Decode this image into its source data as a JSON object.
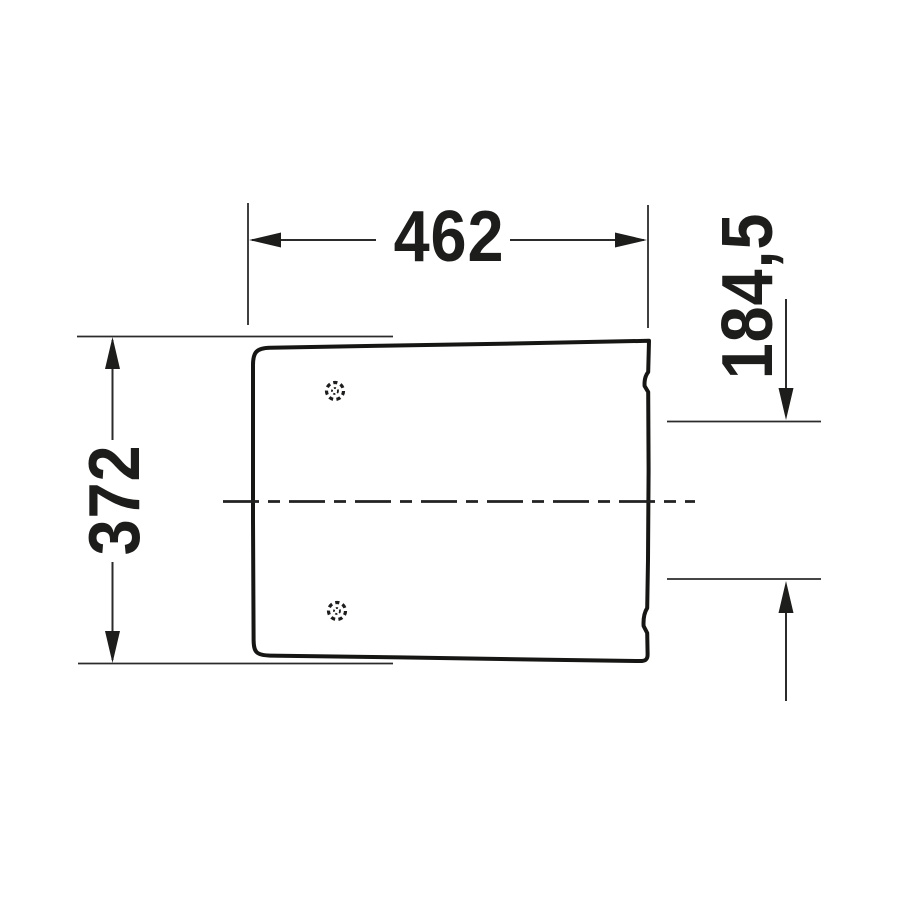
{
  "drawing": {
    "kind": "technical-dimension-drawing",
    "subject": "toilet seat top view with hinge holes",
    "units": "mm",
    "colors": {
      "line": "#1d1d1b",
      "background": "#ffffff"
    },
    "labels": {
      "width": "462",
      "height": "372",
      "offset": "184,5"
    }
  }
}
